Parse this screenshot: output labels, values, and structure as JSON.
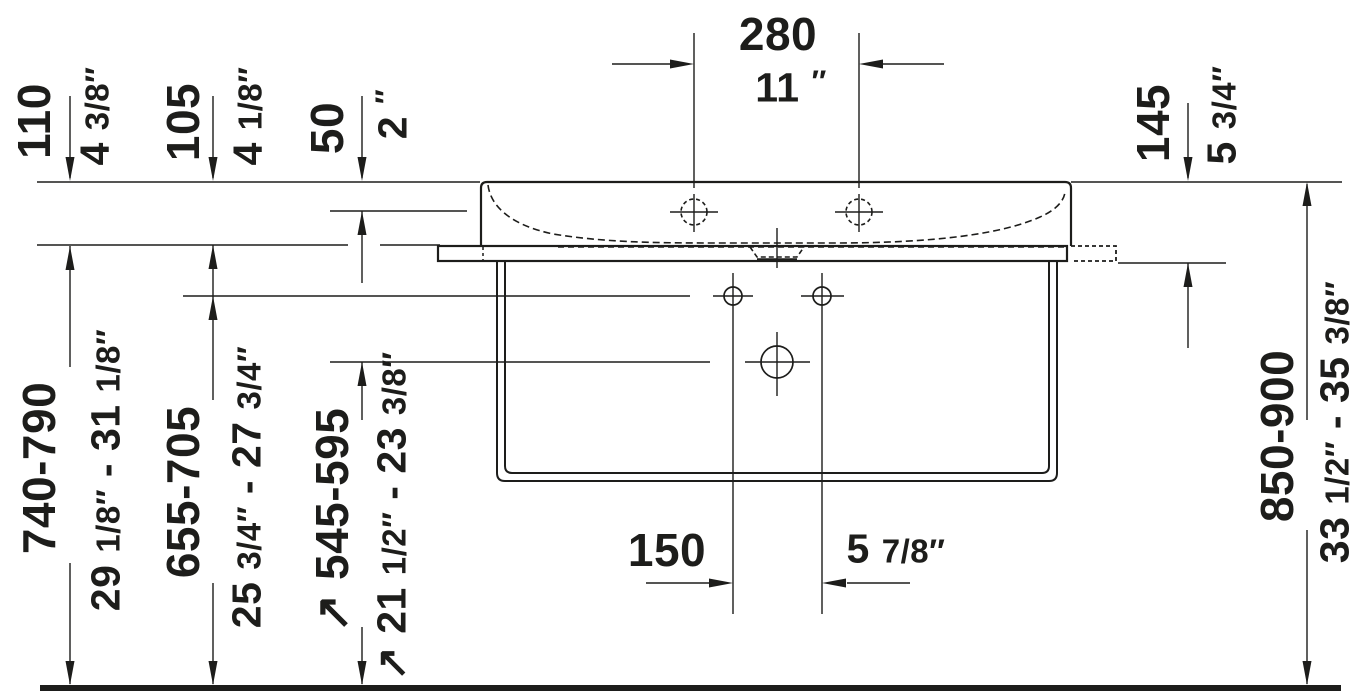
{
  "drawing": {
    "subject": "wall-mounted washbasin with console frame, front elevation, technical installation drawing",
    "units": "millimetres over inches",
    "colors": {
      "line": "#1d1d1b",
      "background": "#ffffff"
    }
  },
  "dims": {
    "tap_hole_spacing": {
      "mm": "280",
      "inch": "11 ″"
    },
    "height_110": {
      "mm": "110",
      "inch": "4 3/8″"
    },
    "height_105": {
      "mm": "105",
      "inch": "4 1/8″"
    },
    "basin_depth_50": {
      "mm": "50",
      "inch": "2 ″"
    },
    "height_145": {
      "mm": "145",
      "inch": "5 3/4″"
    },
    "floor_to_basin_bottom": {
      "mm": "740-790",
      "inch": "29 1/8″ - 31 1/8″"
    },
    "floor_to_fixing_holes": {
      "mm": "655-705",
      "inch": "25 3/4″ - 27 3/4″"
    },
    "floor_to_drain": {
      "mm": "↗ 545-595",
      "inch": "↗ 21 1/2″ - 23 3/8″"
    },
    "floor_to_rim": {
      "mm": "850-900",
      "inch": "33 1/2″ - 35 3/8″"
    },
    "fixing_hole_spacing": {
      "mm": "150",
      "inch": "5 7/8″"
    }
  }
}
